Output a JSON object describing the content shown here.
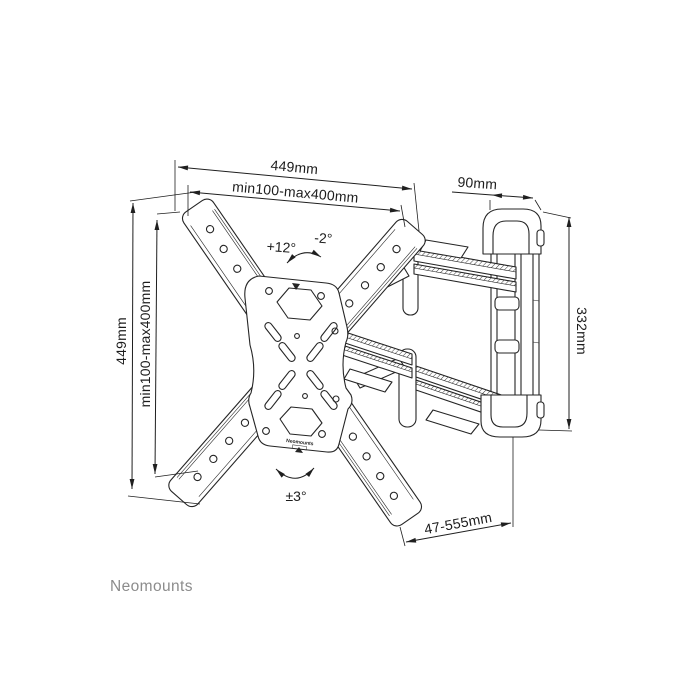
{
  "drawing": {
    "dimensions": {
      "top_width": "449mm",
      "top_vesa_width": "min100-max400mm",
      "wall_plate_width": "90mm",
      "left_height": "449mm",
      "left_vesa_height": "min100-max400mm",
      "wall_plate_height": "332mm",
      "extension_range": "47-555mm"
    },
    "angles": {
      "tilt_up": "+12°",
      "tilt_down": "-2°",
      "level_adjust": "±3°"
    },
    "branding": {
      "logo_text": "Neomounts",
      "plate_label": "Neomounts"
    },
    "colors": {
      "line": "#252525",
      "logo_gray": "#8c8c8c",
      "background": "#ffffff"
    }
  }
}
